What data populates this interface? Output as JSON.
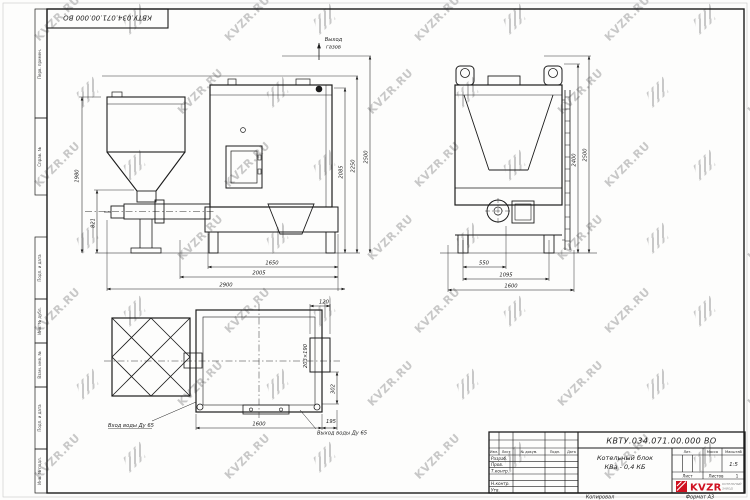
{
  "sheet": {
    "corner_stamp": "КВТУ.034.071.00.000 ВО",
    "watermark_text": "KVZR.RU",
    "copied_label": "Копировал",
    "format_label": "Формат А3"
  },
  "colors": {
    "line": "#1c1c1c",
    "logo_red": "#cf1020",
    "watermark": "#949494"
  },
  "margin_labels": {
    "m1": "Перв. примен.",
    "m2": "Справ. №",
    "m3": "Подп. и дата",
    "m4": "Инв. № дубл.",
    "m5": "Взам. инв. №",
    "m6": "Подп. и дата",
    "m7": "Инв. № подл."
  },
  "views": {
    "front": {
      "gas_label_1": "Выход",
      "gas_label_2": "газов",
      "dims": {
        "height_left": "1980",
        "burner_height": "821",
        "bottom_1": "1650",
        "bottom_2": "2005",
        "bottom_3": "2900",
        "right_1": "2085",
        "right_2": "2250",
        "right_3": "2500"
      }
    },
    "side": {
      "dims": {
        "right_1": "2400",
        "right_2": "2500",
        "bottom_1": "550",
        "bottom_2": "1095",
        "bottom_3": "1600"
      }
    },
    "plan": {
      "inlet_label": "Вход воды Ду 65",
      "outlet_label": "Выход воды Ду 65",
      "dims": {
        "top": "120",
        "window": "203×190",
        "right": "302",
        "bottom_1": "1600",
        "bottom_2": "195"
      }
    }
  },
  "title_block": {
    "doc_number": "КВТУ.034.071.00.000 ВО",
    "product_name_1": "Котельный блок",
    "product_name_2": "КВа - 0,4 КБ",
    "col_headers": {
      "izm": "Изм.",
      "list": "Лист",
      "doc": "№ докум.",
      "sign": "Подп.",
      "date": "Дата"
    },
    "rows": {
      "r1": "Разраб.",
      "r2": "Пров.",
      "r3": "Т.контр.",
      "r4": "Н.контр.",
      "r5": "Утв."
    },
    "lit_label": "Лит.",
    "mass_label": "Масса",
    "scale_label": "Масштаб",
    "scale_value": "1:5",
    "sheet_label": "Лист",
    "sheets_label": "Листов",
    "sheets_value": "1",
    "logo_text": "KVZR",
    "logo_sub_1": "КОТЕЛЬНЫЙ",
    "logo_sub_2": "ЗАВОД"
  }
}
